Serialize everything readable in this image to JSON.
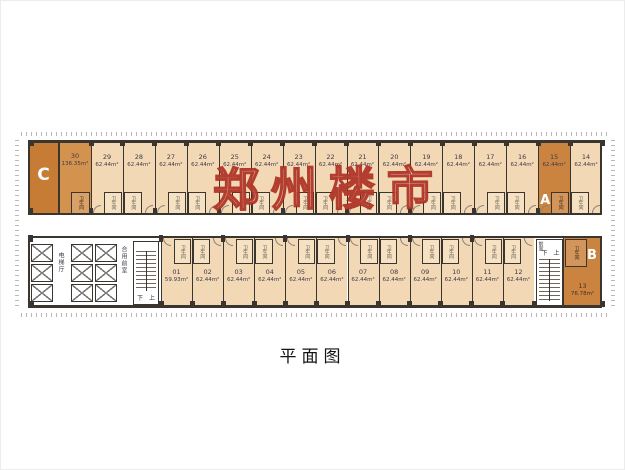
{
  "page": {
    "caption": "平面图",
    "watermark": "郑州楼市"
  },
  "legend": {
    "bathroom": "卫生间",
    "elevator_hall": "电梯厅",
    "shared_front_room": "合用前室",
    "front_room": "前室",
    "stair_up": "上",
    "stair_down": "下"
  },
  "colors": {
    "wall": "#3a362f",
    "unit_fill": "#f2d8b4",
    "bathroom_fill": "#f6e2c2",
    "highlight": "#cb8440",
    "highlight_c": "#c67c35",
    "highlight_30": "#d3924e",
    "text": "#3f3b4b",
    "text_on_orange": "#46321c",
    "letter_color": "#ffffff",
    "watermark_red": "#a82416"
  },
  "top_row": {
    "corner_unit": {
      "letter": "C",
      "number": "30",
      "area": "136.35m²"
    },
    "units": [
      {
        "number": "29",
        "area": "62.44m²"
      },
      {
        "number": "28",
        "area": "62.44m²"
      },
      {
        "number": "27",
        "area": "62.44m²"
      },
      {
        "number": "26",
        "area": "62.44m²"
      },
      {
        "number": "25",
        "area": "62.44m²"
      },
      {
        "number": "24",
        "area": "62.44m²"
      },
      {
        "number": "23",
        "area": "62.44m²"
      },
      {
        "number": "22",
        "area": "62.44m²"
      },
      {
        "number": "21",
        "area": "62.44m²"
      },
      {
        "number": "20",
        "area": "62.44m²"
      },
      {
        "number": "19",
        "area": "62.44m²"
      },
      {
        "number": "18",
        "area": "62.44m²"
      },
      {
        "number": "17",
        "area": "62.44m²"
      },
      {
        "number": "16",
        "area": "62.44m²"
      },
      {
        "number": "15",
        "area": "62.44m²",
        "letter": "A",
        "highlight": true
      },
      {
        "number": "14",
        "area": "62.44m²"
      }
    ]
  },
  "bottom_row": {
    "units": [
      {
        "number": "01",
        "area": "59.93m²"
      },
      {
        "number": "02",
        "area": "62.44m²"
      },
      {
        "number": "03",
        "area": "62.44m²"
      },
      {
        "number": "04",
        "area": "62.44m²"
      },
      {
        "number": "05",
        "area": "62.44m²"
      },
      {
        "number": "06",
        "area": "62.44m²"
      },
      {
        "number": "07",
        "area": "62.44m²"
      },
      {
        "number": "08",
        "area": "62.44m²"
      },
      {
        "number": "09",
        "area": "62.44m²"
      },
      {
        "number": "10",
        "area": "62.44m²"
      },
      {
        "number": "11",
        "area": "62.44m²"
      },
      {
        "number": "12",
        "area": "62.44m²"
      }
    ],
    "corner_unit": {
      "letter": "B",
      "number": "13",
      "area": "76.78m²",
      "highlight": true
    }
  }
}
